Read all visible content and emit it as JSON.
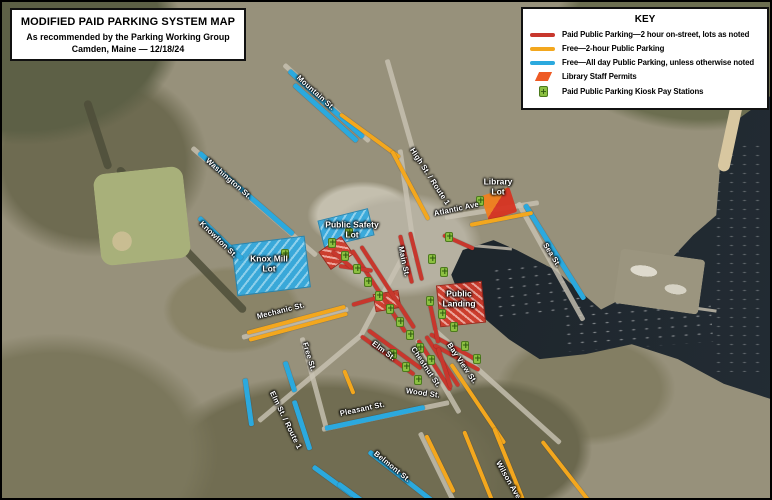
{
  "title_box": {
    "line1": "MODIFIED PAID PARKING SYSTEM MAP",
    "line2": "As recommended by the Parking Working Group",
    "line3": "Camden, Maine — 12/18/24"
  },
  "key": {
    "title": "KEY",
    "items": [
      {
        "icon": "red-line-icon",
        "swatch": "line",
        "color": "#c8372d",
        "label": "Paid Public Parking—2 hour on-street, lots as noted"
      },
      {
        "icon": "yellow-line-icon",
        "swatch": "line",
        "color": "#f3a71e",
        "label": "Free—2-hour Public Parking"
      },
      {
        "icon": "blue-line-icon",
        "swatch": "line",
        "color": "#2ba9de",
        "label": "Free—All day Public Parking, unless otherwise noted"
      },
      {
        "icon": "library-permit-icon",
        "swatch": "parallelogram",
        "color": "#ee5a24",
        "label": "Library Staff Permits"
      },
      {
        "icon": "kiosk-icon",
        "swatch": "kiosk",
        "color": "#8cc041",
        "label": "Paid Public Parking Kiosk Pay Stations"
      }
    ]
  },
  "colors": {
    "paid": "#c8372d",
    "free2hr": "#f3a71e",
    "freeAllDay": "#2ba9de",
    "kiosk": "#8cc041",
    "kioskBorder": "#4c7a1d",
    "library": "#ee5a24",
    "water": "#222a31"
  },
  "map": {
    "street_labels": [
      {
        "text": "Mountain St.",
        "x": 296,
        "y": 70,
        "angle": 42
      },
      {
        "text": "Washington St.",
        "x": 205,
        "y": 153,
        "angle": 41
      },
      {
        "text": "Knowlton St.",
        "x": 199,
        "y": 216,
        "angle": 44
      },
      {
        "text": "High St. / Route 1",
        "x": 410,
        "y": 142,
        "angle": 57
      },
      {
        "text": "Main St.",
        "x": 399,
        "y": 240,
        "angle": 78
      },
      {
        "text": "Atlantic Ave",
        "x": 432,
        "y": 207,
        "angle": -12
      },
      {
        "text": "Sea St.",
        "x": 543,
        "y": 237,
        "angle": 58
      },
      {
        "text": "Mechanic St.",
        "x": 255,
        "y": 310,
        "angle": -14
      },
      {
        "text": "Free St.",
        "x": 303,
        "y": 336,
        "angle": 73
      },
      {
        "text": "Elm St.",
        "x": 371,
        "y": 336,
        "angle": 37
      },
      {
        "text": "Chestnut St.",
        "x": 411,
        "y": 341,
        "angle": 56
      },
      {
        "text": "Bay View St.",
        "x": 447,
        "y": 337,
        "angle": 56
      },
      {
        "text": "Wood St.",
        "x": 404,
        "y": 384,
        "angle": 8
      },
      {
        "text": "Elm St. / Route 1",
        "x": 270,
        "y": 385,
        "angle": 64
      },
      {
        "text": "Pleasant St.",
        "x": 338,
        "y": 407,
        "angle": -12
      },
      {
        "text": "Belmont St.",
        "x": 373,
        "y": 446,
        "angle": 39
      },
      {
        "text": "Wilson Ave",
        "x": 496,
        "y": 455,
        "angle": 60
      }
    ],
    "lot_labels": [
      {
        "text": "Public Safety\nLot",
        "x": 350,
        "y": 228
      },
      {
        "text": "Knox Mill\nLot",
        "x": 267,
        "y": 262
      },
      {
        "text": "Public\nLanding",
        "x": 457,
        "y": 297
      },
      {
        "text": "Library\nLot",
        "x": 496,
        "y": 185
      }
    ],
    "segments": [
      {
        "type": "freeAllDay",
        "x": 287,
        "y": 66,
        "len": 100,
        "angle": 42
      },
      {
        "type": "freeAllDay",
        "x": 292,
        "y": 80,
        "len": 85,
        "angle": 42
      },
      {
        "type": "freeAllDay",
        "x": 197,
        "y": 148,
        "len": 125,
        "angle": 41
      },
      {
        "type": "freeAllDay",
        "x": 197,
        "y": 213,
        "len": 60,
        "angle": 44
      },
      {
        "type": "freeAllDay",
        "x": 523,
        "y": 200,
        "len": 112,
        "angle": 58
      },
      {
        "type": "freeAllDay",
        "x": 283,
        "y": 357,
        "len": 32,
        "angle": 72
      },
      {
        "type": "freeAllDay",
        "x": 323,
        "y": 424,
        "len": 102,
        "angle": -12
      },
      {
        "type": "freeAllDay",
        "x": 367,
        "y": 447,
        "len": 88,
        "angle": 38
      },
      {
        "type": "freeAllDay",
        "x": 292,
        "y": 396,
        "len": 52,
        "angle": 72
      },
      {
        "type": "freeAllDay",
        "x": 243,
        "y": 374,
        "len": 48,
        "angle": 82
      },
      {
        "type": "freeAllDay",
        "x": 311,
        "y": 462,
        "len": 50,
        "angle": 36
      },
      {
        "type": "freeAllDay",
        "x": 336,
        "y": 479,
        "len": 42,
        "angle": 36
      },
      {
        "type": "free2hr",
        "x": 338,
        "y": 110,
        "len": 74,
        "angle": 36
      },
      {
        "type": "free2hr",
        "x": 390,
        "y": 147,
        "len": 78,
        "angle": 62
      },
      {
        "type": "free2hr",
        "x": 468,
        "y": 221,
        "len": 64,
        "angle": -11
      },
      {
        "type": "free2hr",
        "x": 245,
        "y": 329,
        "len": 102,
        "angle": -15
      },
      {
        "type": "free2hr",
        "x": 247,
        "y": 336,
        "len": 102,
        "angle": -15
      },
      {
        "type": "free2hr",
        "x": 342,
        "y": 366,
        "len": 26,
        "angle": 68
      },
      {
        "type": "free2hr",
        "x": 449,
        "y": 360,
        "len": 96,
        "angle": 56
      },
      {
        "type": "free2hr",
        "x": 462,
        "y": 427,
        "len": 76,
        "angle": 68
      },
      {
        "type": "free2hr",
        "x": 492,
        "y": 424,
        "len": 84,
        "angle": 68
      },
      {
        "type": "free2hr",
        "x": 540,
        "y": 437,
        "len": 76,
        "angle": 52
      },
      {
        "type": "free2hr",
        "x": 424,
        "y": 431,
        "len": 64,
        "angle": 64
      },
      {
        "type": "paid",
        "x": 350,
        "y": 246,
        "len": 98,
        "angle": 57
      },
      {
        "type": "paid",
        "x": 359,
        "y": 242,
        "len": 98,
        "angle": 57
      },
      {
        "type": "paid",
        "x": 398,
        "y": 231,
        "len": 50,
        "angle": 76
      },
      {
        "type": "paid",
        "x": 408,
        "y": 228,
        "len": 50,
        "angle": 76
      },
      {
        "type": "paid",
        "x": 359,
        "y": 332,
        "len": 66,
        "angle": 36
      },
      {
        "type": "paid",
        "x": 366,
        "y": 326,
        "len": 66,
        "angle": 36
      },
      {
        "type": "paid",
        "x": 416,
        "y": 336,
        "len": 60,
        "angle": 57
      },
      {
        "type": "paid",
        "x": 424,
        "y": 332,
        "len": 60,
        "angle": 57
      },
      {
        "type": "paid",
        "x": 428,
        "y": 330,
        "len": 52,
        "angle": 29
      },
      {
        "type": "paid",
        "x": 432,
        "y": 341,
        "len": 52,
        "angle": 29
      },
      {
        "type": "paid",
        "x": 350,
        "y": 301,
        "len": 36,
        "angle": -16
      },
      {
        "type": "paid",
        "x": 441,
        "y": 231,
        "len": 34,
        "angle": 24
      },
      {
        "type": "paid",
        "x": 428,
        "y": 300,
        "len": 40,
        "angle": 78
      },
      {
        "type": "paid",
        "x": 436,
        "y": 344,
        "len": 42,
        "angle": 72
      },
      {
        "type": "paid",
        "x": 337,
        "y": 262,
        "len": 34,
        "angle": 8
      },
      {
        "type": "paid",
        "x": 330,
        "y": 247,
        "len": 26,
        "angle": 40
      }
    ],
    "lots": [
      {
        "type": "hatch-blue",
        "name": "knox-mill-lot",
        "x": 232,
        "y": 238,
        "w": 72,
        "h": 50,
        "angle": -7
      },
      {
        "type": "hatch-blue",
        "name": "public-safety-lot",
        "x": 318,
        "y": 212,
        "w": 50,
        "h": 26,
        "angle": -14
      },
      {
        "type": "hatch-red",
        "name": "public-landing-lot",
        "x": 436,
        "y": 281,
        "w": 44,
        "h": 40,
        "angle": -6
      },
      {
        "type": "hatch-red",
        "name": "small-paid-lot-west",
        "x": 320,
        "y": 240,
        "w": 26,
        "h": 20,
        "angle": -35
      },
      {
        "type": "hatch-red",
        "name": "small-paid-lot-center",
        "x": 372,
        "y": 290,
        "w": 24,
        "h": 16,
        "angle": -10
      },
      {
        "type": "library",
        "name": "library-lot",
        "x": 482,
        "y": 189,
        "w": 30,
        "h": 26,
        "angle": -18
      }
    ],
    "kiosks": [
      {
        "x": 330,
        "y": 241
      },
      {
        "x": 343,
        "y": 254
      },
      {
        "x": 355,
        "y": 267
      },
      {
        "x": 366,
        "y": 280
      },
      {
        "x": 377,
        "y": 294
      },
      {
        "x": 388,
        "y": 307
      },
      {
        "x": 398,
        "y": 320
      },
      {
        "x": 408,
        "y": 333
      },
      {
        "x": 418,
        "y": 346
      },
      {
        "x": 429,
        "y": 358
      },
      {
        "x": 428,
        "y": 299
      },
      {
        "x": 440,
        "y": 312
      },
      {
        "x": 452,
        "y": 325
      },
      {
        "x": 391,
        "y": 352
      },
      {
        "x": 404,
        "y": 365
      },
      {
        "x": 416,
        "y": 378
      },
      {
        "x": 430,
        "y": 257
      },
      {
        "x": 442,
        "y": 270
      },
      {
        "x": 478,
        "y": 199
      },
      {
        "x": 447,
        "y": 235
      },
      {
        "x": 463,
        "y": 344
      },
      {
        "x": 475,
        "y": 357
      },
      {
        "x": 283,
        "y": 252
      },
      {
        "x": 347,
        "y": 231
      }
    ],
    "base_roads": [
      {
        "x": 282,
        "y": 60,
        "len": 115,
        "angle": 42
      },
      {
        "x": 190,
        "y": 143,
        "len": 165,
        "angle": 41
      },
      {
        "x": 385,
        "y": 55,
        "len": 95,
        "angle": 74
      },
      {
        "x": 398,
        "y": 145,
        "len": 110,
        "angle": 82
      },
      {
        "x": 402,
        "y": 250,
        "len": 93,
        "angle": 118
      },
      {
        "x": 360,
        "y": 330,
        "len": 135,
        "angle": 140
      },
      {
        "x": 432,
        "y": 325,
        "len": 170,
        "angle": 42
      },
      {
        "x": 443,
        "y": 213,
        "len": 95,
        "angle": -9
      },
      {
        "x": 516,
        "y": 198,
        "len": 135,
        "angle": 61
      },
      {
        "x": 240,
        "y": 333,
        "len": 110,
        "angle": -15
      },
      {
        "x": 300,
        "y": 333,
        "len": 95,
        "angle": 75
      },
      {
        "x": 320,
        "y": 425,
        "len": 130,
        "angle": -12
      },
      {
        "x": 415,
        "y": 335,
        "len": 85,
        "angle": 60
      },
      {
        "x": 418,
        "y": 428,
        "len": 90,
        "angle": 64
      }
    ]
  }
}
